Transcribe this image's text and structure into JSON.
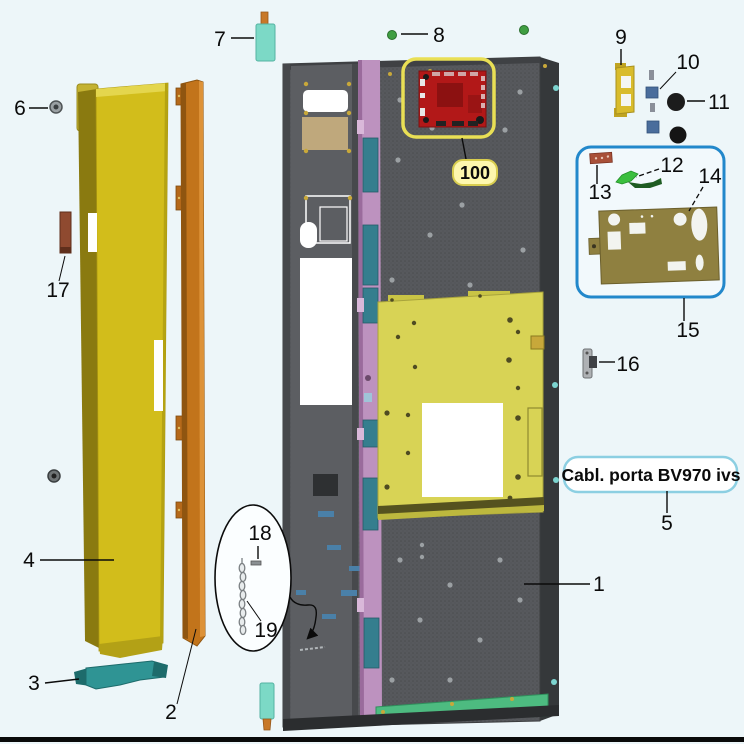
{
  "diagram": {
    "product_box": {
      "text": "Cabl. porta BV970 ivs"
    },
    "labels": {
      "n1": "1",
      "n2": "2",
      "n3": "3",
      "n4": "4",
      "n5": "5",
      "n6": "6",
      "n7": "7",
      "n8": "8",
      "n9": "9",
      "n10": "10",
      "n11": "11",
      "n12": "12",
      "n13": "13",
      "n14": "14",
      "n15": "15",
      "n16": "16",
      "n17": "17",
      "n18": "18",
      "n19": "19",
      "n100": "100"
    },
    "parts": [
      {
        "number": "1",
        "name": "inner-door-panel"
      },
      {
        "number": "2",
        "name": "edge-strip-orange"
      },
      {
        "number": "3",
        "name": "bottom-handle-bracket"
      },
      {
        "number": "4",
        "name": "outer-door-panel"
      },
      {
        "number": "5",
        "name": "door-harness-callout"
      },
      {
        "number": "6",
        "name": "screw"
      },
      {
        "number": "7",
        "name": "hinge-bushing"
      },
      {
        "number": "8",
        "name": "green-screw"
      },
      {
        "number": "9",
        "name": "yellow-bracket"
      },
      {
        "number": "10",
        "name": "spacer-pads"
      },
      {
        "number": "11",
        "name": "round-bumper"
      },
      {
        "number": "12",
        "name": "green-cable"
      },
      {
        "number": "13",
        "name": "brown-connector"
      },
      {
        "number": "14",
        "name": "mounting-plate"
      },
      {
        "number": "15",
        "name": "bracket-kit-group"
      },
      {
        "number": "16",
        "name": "latch-plate"
      },
      {
        "number": "17",
        "name": "brown-clip"
      },
      {
        "number": "18",
        "name": "pin"
      },
      {
        "number": "19",
        "name": "chain"
      },
      {
        "number": "100",
        "name": "control-board"
      }
    ],
    "colors": {
      "background": "#edf6f9",
      "door_gray": "#57595d",
      "door_edge": "#35383a",
      "outer_door_yellow": "#d2bd1b",
      "edge_strip_orange": "#c2741b",
      "handle_teal": "#2f9494",
      "plate_yellow": "#d8d355",
      "strip_pink": "#bd92bf",
      "strip_teal": "#357e8e",
      "bottom_green": "#4dbb80",
      "pcb_red": "#b21818",
      "highlight_yellow": "#e9df55",
      "badge_fill": "#fdf7ae",
      "group_box_blue": "#2288cb",
      "callout_border_cyan": "#8ccfe2",
      "bushing_teal": "#7cd9c6",
      "pin_orange": "#c87828",
      "screw_green": "#3f9e42"
    }
  }
}
